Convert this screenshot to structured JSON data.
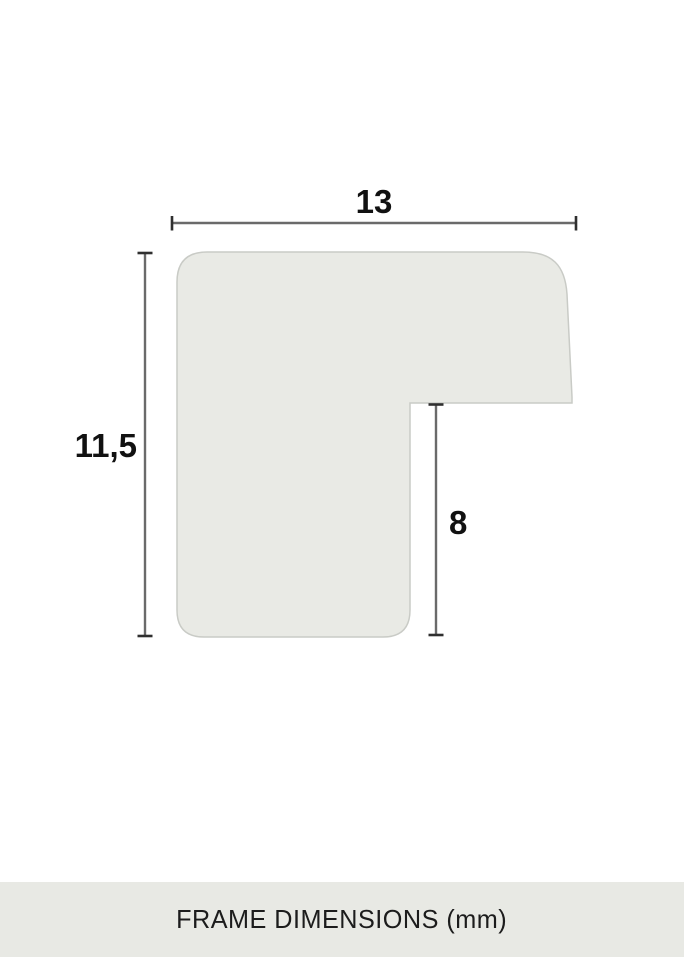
{
  "diagram": {
    "title": "frame-profile-cross-section",
    "shape_fill": "#e9eae5",
    "shape_stroke": "#c9cbc6",
    "dimension_line_color": "#6a6a6a",
    "dimension_tick_color": "#2f2f2f",
    "label_color": "#111111",
    "dimensions": {
      "width_mm": {
        "label": "13"
      },
      "height_mm": {
        "label": "11,5"
      },
      "rabbet_depth_mm": {
        "label": "8"
      }
    }
  },
  "footer": {
    "label": "FRAME DIMENSIONS (mm)",
    "background": "#e8e9e4",
    "text_color": "#1c1c1c",
    "unit": "mm"
  }
}
